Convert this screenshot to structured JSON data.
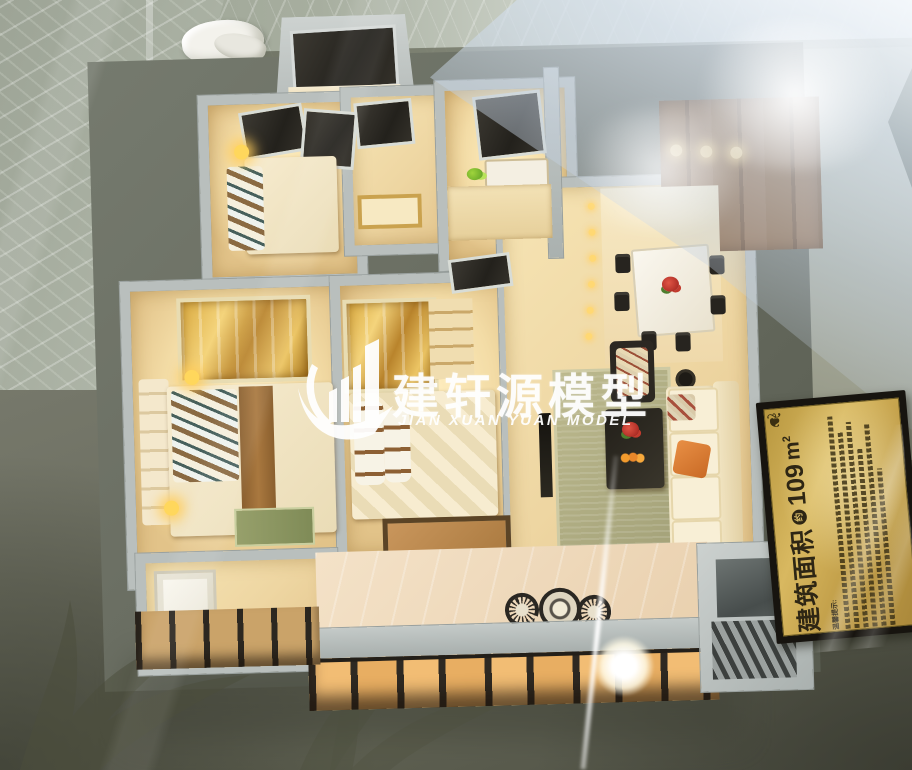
{
  "scene": {
    "description": "Photograph of an illuminated apartment scale model displayed under glass",
    "rooms": [
      "master-bedroom",
      "second-bedroom",
      "small-bedroom",
      "bathroom",
      "kitchen",
      "entry-hall",
      "dining-area",
      "living-room",
      "utility-room",
      "balcony"
    ]
  },
  "watermark": {
    "company_cn": "建轩源模型",
    "company_en": "JIAN XUAN YUAN MODEL",
    "logo": "building-swoosh-icon",
    "color": "#ffffff"
  },
  "plaque": {
    "area_label": "建筑面积",
    "approx_badge": "约",
    "area_value": "109",
    "area_unit": "m",
    "area_sup": "2",
    "notice_label": "温馨提示:",
    "flourish": "❦",
    "gold_color": "#c8a650",
    "frame_color": "#17140f",
    "text_color": "#2e2614"
  },
  "colors": {
    "model_wall": "#b9bfbd",
    "room_warm": "#f2dfae",
    "lamp_glow": "#ffd75c",
    "table_olive": "#6e7062",
    "marble": "#a7ae9f",
    "sky_reflection": "#d7e2ee",
    "facade_dark": "#2e2922",
    "facade_pane": "#f2bd74"
  }
}
